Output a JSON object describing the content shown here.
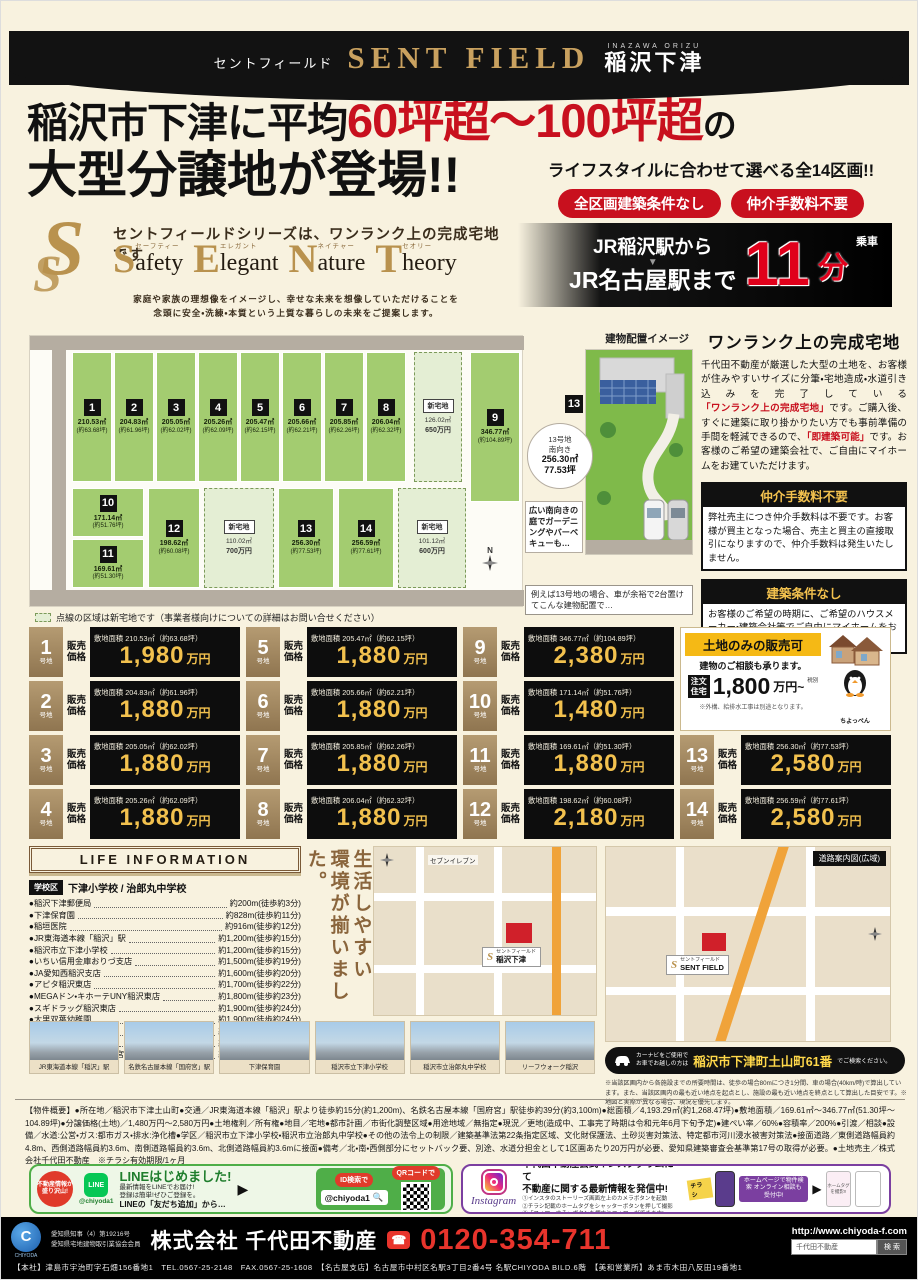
{
  "header": {
    "kana": "セントフィールド",
    "logo": "SENT FIELD",
    "romaji": "INAZAWA ORIZU",
    "area": "稲沢下津"
  },
  "headline": {
    "line1_pre": "稲沢市下津に平均",
    "line1_red": "60坪超～100坪超",
    "line1_post": "の",
    "line2": "大型分譲地が登場!!",
    "sub": "ライフスタイルに合わせて選べる全14区画!!",
    "badges": [
      "全区画建築条件なし",
      "仲介手数料不要"
    ]
  },
  "brand": {
    "tagline": "セントフィールドシリーズは、ワンランク上の完成宅地です",
    "logo_letter": "S",
    "words": [
      {
        "initial": "S",
        "rest": "afety",
        "kana": "セーフティー"
      },
      {
        "initial": "E",
        "rest": "legant",
        "kana": "エレガント"
      },
      {
        "initial": "N",
        "rest": "ature",
        "kana": "ネイチャー"
      },
      {
        "initial": "T",
        "rest": "heory",
        "kana": "セオリー"
      }
    ],
    "desc1": "家庭や家族の理想像をイメージし、幸せな未来を想像していただけることを",
    "desc2": "念頭に安全・洗練・本質という上質な暮らしの未来をご提案します。"
  },
  "access": {
    "from": "JR稲沢駅から",
    "arrow": "▼",
    "to": "JR名古屋駅まで",
    "minutes": "11",
    "unit": "分",
    "ride": "乗車"
  },
  "plan": {
    "caption": "建物配置イメージ",
    "legend": "点線の区域は新宅地です（事業者様向けについての詳細はお問い合せください）",
    "compass": "N",
    "lots": [
      {
        "no": "1",
        "area": "210.53㎡",
        "tsubo": "(約63.68坪)",
        "x": 42,
        "y": 16,
        "w": 40,
        "h": 130
      },
      {
        "no": "2",
        "area": "204.83㎡",
        "tsubo": "(約61.96坪)",
        "x": 84,
        "y": 16,
        "w": 40,
        "h": 130
      },
      {
        "no": "3",
        "area": "205.05㎡",
        "tsubo": "(約62.02坪)",
        "x": 126,
        "y": 16,
        "w": 40,
        "h": 130
      },
      {
        "no": "4",
        "area": "205.26㎡",
        "tsubo": "(約62.09坪)",
        "x": 168,
        "y": 16,
        "w": 40,
        "h": 130
      },
      {
        "no": "5",
        "area": "205.47㎡",
        "tsubo": "(約62.15坪)",
        "x": 210,
        "y": 16,
        "w": 40,
        "h": 130
      },
      {
        "no": "6",
        "area": "205.66㎡",
        "tsubo": "(約62.21坪)",
        "x": 252,
        "y": 16,
        "w": 40,
        "h": 130
      },
      {
        "no": "7",
        "area": "205.85㎡",
        "tsubo": "(約62.26坪)",
        "x": 294,
        "y": 16,
        "w": 40,
        "h": 130
      },
      {
        "no": "8",
        "area": "206.04㎡",
        "tsubo": "(約62.32坪)",
        "x": 336,
        "y": 16,
        "w": 40,
        "h": 130
      },
      {
        "no": "9",
        "area": "346.77㎡",
        "tsubo": "(約104.89坪)",
        "x": 440,
        "y": 16,
        "w": 50,
        "h": 150
      },
      {
        "no": "10",
        "area": "171.14㎡",
        "tsubo": "(約51.76坪)",
        "x": 42,
        "y": 152,
        "w": 72,
        "h": 49
      },
      {
        "no": "11",
        "area": "169.61㎡",
        "tsubo": "(約51.30坪)",
        "x": 42,
        "y": 203,
        "w": 72,
        "h": 49
      },
      {
        "no": "12",
        "area": "198.62㎡",
        "tsubo": "(約60.08坪)",
        "x": 118,
        "y": 152,
        "w": 52,
        "h": 100
      },
      {
        "no": "13",
        "area": "256.30㎡",
        "tsubo": "(約77.53坪)",
        "x": 248,
        "y": 152,
        "w": 56,
        "h": 100
      },
      {
        "no": "14",
        "area": "256.59㎡",
        "tsubo": "(約77.61坪)",
        "x": 308,
        "y": 152,
        "w": 56,
        "h": 100
      }
    ],
    "new_lots": [
      {
        "label": "新宅地",
        "area": "126.02㎡",
        "price": "650万円",
        "x": 384,
        "y": 16,
        "w": 48,
        "h": 130
      },
      {
        "label": "新宅地",
        "area": "110.02㎡",
        "price": "700万円",
        "x": 174,
        "y": 152,
        "w": 70,
        "h": 100
      },
      {
        "label": "新宅地",
        "area": "101.12㎡",
        "price": "600万円",
        "x": 368,
        "y": 152,
        "w": 68,
        "h": 100
      }
    ],
    "callout": {
      "num": "13",
      "l1": "13号地",
      "l2": "南向き",
      "l3": "256.30㎡",
      "l4": "77.53坪"
    },
    "bubble": "広い南向きの庭でガーデニングやバーベキューも…",
    "example": "例えば13号地の場合、車が余裕で2台置けてこんな建物配置で…"
  },
  "feature": {
    "title": "ワンランク上の完成宅地",
    "p1": "千代田不動産が厳選した大型の土地を、お客様が住みやすいサイズに分筆・宅地造成・水道引き込みを完了している",
    "red1": "「ワンランク上の完成宅地」",
    "p2": "です。ご購入後、すぐに建築に取り掛かりたい方でも事前準備の手間を軽減できるので、",
    "red2": "「即建築可能」",
    "p3": "です。お客様のご希望の建築会社で、ご自由にマイホームをお建ていただけます。",
    "box1": {
      "title": "仲介手数料不要",
      "body": "弊社売主につき仲介手数料は不要です。お客様が買主となった場合、売主と買主の直接取引になりますので、仲介手数料は発生いたしません。"
    },
    "box2": {
      "title": "建築条件なし",
      "body": "お客様のご希望の時期に、ご希望のハウスメーカー・建築会社等でご自由にマイホームをお建ていただけます。"
    }
  },
  "prices": {
    "labels": {
      "suffix": "号地",
      "sale1": "販売",
      "sale2": "価格",
      "area_label": "敷地面積",
      "unit": "万円"
    },
    "columns": [
      [
        0,
        1,
        2,
        3
      ],
      [
        4,
        5,
        6,
        7
      ],
      [
        8,
        9,
        10,
        11
      ],
      [
        12,
        13
      ]
    ],
    "lots": [
      {
        "no": "1",
        "area": "敷地面積 210.53㎡（約63.68坪）",
        "price": "1,980"
      },
      {
        "no": "2",
        "area": "敷地面積 204.83㎡（約61.96坪）",
        "price": "1,880"
      },
      {
        "no": "3",
        "area": "敷地面積 205.05㎡（約62.02坪）",
        "price": "1,880"
      },
      {
        "no": "4",
        "area": "敷地面積 205.26㎡（約62.09坪）",
        "price": "1,880"
      },
      {
        "no": "5",
        "area": "敷地面積 205.47㎡（約62.15坪）",
        "price": "1,880"
      },
      {
        "no": "6",
        "area": "敷地面積 205.66㎡（約62.21坪）",
        "price": "1,880"
      },
      {
        "no": "7",
        "area": "敷地面積 205.85㎡（約62.26坪）",
        "price": "1,880"
      },
      {
        "no": "8",
        "area": "敷地面積 206.04㎡（約62.32坪）",
        "price": "1,880"
      },
      {
        "no": "9",
        "area": "敷地面積 346.77㎡（約104.89坪）",
        "price": "2,380"
      },
      {
        "no": "10",
        "area": "敷地面積 171.14㎡（約51.76坪）",
        "price": "1,480"
      },
      {
        "no": "11",
        "area": "敷地面積 169.61㎡（約51.30坪）",
        "price": "1,880"
      },
      {
        "no": "12",
        "area": "敷地面積 198.62㎡（約60.08坪）",
        "price": "2,180"
      },
      {
        "no": "13",
        "area": "敷地面積 256.30㎡（約77.53坪）",
        "price": "2,580"
      },
      {
        "no": "14",
        "area": "敷地面積 256.59㎡（約77.61坪）",
        "price": "2,580"
      }
    ]
  },
  "landonly": {
    "header": "土地のみの販売可",
    "sub": "建物のご相談も承ります。",
    "badge1": "注文",
    "badge2": "住宅",
    "price": "1,800",
    "unit": "万円~",
    "tax": "税別",
    "note": "※外構、給排水工事は別途となります。",
    "mascot": "ちよっぺん"
  },
  "life": {
    "header": "LIFE INFORMATION",
    "school_label": "学校区",
    "school": "下津小学校 / 治郎丸中学校",
    "items": [
      {
        "name": "●稲沢下津郵便局",
        "dist": "約200m(徒歩約3分)"
      },
      {
        "name": "●下津保育園",
        "dist": "約828m(徒歩約11分)"
      },
      {
        "name": "●稲垣医院",
        "dist": "約916m(徒歩約12分)"
      },
      {
        "name": "●JR東海道本線「稲沢」駅",
        "dist": "約1,200m(徒歩約15分)"
      },
      {
        "name": "●稲沢市立下津小学校",
        "dist": "約1,200m(徒歩約15分)"
      },
      {
        "name": "●いちい信用金庫おりづ支店",
        "dist": "約1,500m(徒歩約19分)"
      },
      {
        "name": "●JA愛知西稲沢支店",
        "dist": "約1,600m(徒歩約20分)"
      },
      {
        "name": "●アピタ稲沢東店",
        "dist": "約1,700m(徒歩約22分)"
      },
      {
        "name": "●MEGAドン・キホーテUNY稲沢東店",
        "dist": "約1,800m(徒歩約23分)"
      },
      {
        "name": "●スギドラッグ稲沢東店",
        "dist": "約1,900m(徒歩約24分)"
      },
      {
        "name": "●大里双葉幼稚園",
        "dist": "約1,900m(徒歩約24分)"
      },
      {
        "name": "●リーフウォーク稲沢",
        "dist": "約1,900m(徒歩約24分)"
      },
      {
        "name": "●稲沢市立治郎丸中学校",
        "dist": "約2,800m(徒歩約36分)"
      },
      {
        "name": "●名鉄名古屋本線「国府宮」駅",
        "dist": "約3,100m(徒歩約39分)"
      }
    ],
    "vertical": [
      "周辺施設が充実。",
      "生活しやすい",
      "環境が揃いました。"
    ]
  },
  "maps": {
    "local": {
      "poi": "セブンイレブン",
      "site1": "セントフィールド",
      "site2": "稲沢下津"
    },
    "wide": {
      "badge": "道路案内図(広域)",
      "site1": "セントフィールド",
      "site2": "SENT FIELD"
    },
    "note": "※当該区画内から各施設までの所要時間は、徒歩の場合80mにつき1分間、車の場合(40km/時)で算出しています。また、当該区画内の最も近い地点を起点とし、施設の最も近い地点を終点として算出した目安です。※地図と実際が異なる場合、現況を優先します。"
  },
  "navi": {
    "pre1": "カーナビをご使用で",
    "pre2": "お車でお越しの方は",
    "address": "稲沢市下津町土山町61番",
    "post": "でご検索ください。"
  },
  "photos": [
    "JR東海道本線「稲沢」駅",
    "名鉄名古屋本線「国府宮」駅",
    "下津保育園",
    "稲沢市立下津小学校",
    "稲沢市立治郎丸中学校",
    "リーフウォーク稲沢"
  ],
  "outline": {
    "text": "【物件概要】●所在地／稲沢市下津土山町●交通／JR東海道本線「稲沢」駅より徒歩約15分(約1,200m)、名鉄名古屋本線「国府宮」駅徒歩約39分(約3,100m)●総面積／4,193.29㎡(約1,268.47坪)●敷地面積／169.61㎡～346.77㎡(51.30坪～104.89坪)●分譲価格(土地)／1,480万円～2,580万円●土地権利／所有権●地目／宅地●都市計画／市街化調整区域●用途地域／無指定●現況／更地(造成中、工事完了時期は令和元年6月下旬予定)●建ぺい率／60%●容積率／200%●引渡／相談●設備／水道:公営・ガス:都市ガス・排水:浄化槽●学区／稲沢市立下津小学校・稲沢市立治郎丸中学校●その他の法令上の制限／建築基準法第22条指定区域、文化財保護法、土砂災害対策法、特定都市河川浸水被害対策法●接面道路／東側道路幅員約4.8m、西側道路幅員約3.6m、南側道路幅員約3.6m、北側道路幅員約3.6mに接面●備考／北・南・西側部分にセットバック要、別途、水道分担金として1区画あたり20万円が必要、愛知県建築審査会基準第17号の取得が必要。●土地売主／株式会社千代田不動産　※チラシ有効期限/1ヶ月"
  },
  "line_promo": {
    "burst": "不動産情報が盛り沢山!",
    "brand": "LINE",
    "handle": "@chiyoda1",
    "title": "LINEはじめました!",
    "s1": "最新情報をLINEでお届け!",
    "s2": "登録は簡単!ぜひご登録を。",
    "s3": "LINEの「友だち追加」から…",
    "id_badge": "ID検索で",
    "id_value": "@chiyoda1",
    "qr_badge": "QRコードで"
  },
  "insta_promo": {
    "logo": "Instagram",
    "t1": "千代田不動産公式インスタグラムにて",
    "t2": "不動産に関する最新情報を発信中!",
    "b1": "①インスタのストーリーズ画面左上のカメラボタンを起動",
    "b2": "②チラシ記載のホームタグをシャッターボタンを押して撮影",
    "b3": "③「フォローする」ボタンを押すとフォローができます!",
    "tag": "チラシ",
    "badge": "ホームページで物件検索 オンライン相談も受付中!",
    "card": "ホームタグを撮影!!"
  },
  "footer": {
    "logo": "C",
    "logo_caption": "CHIYODA",
    "license1": "愛知県知事（4）第19216号",
    "license2": "愛知県宅地建物取引業協会会員",
    "company": "株式会社 千代田不動産",
    "dial": "☎",
    "tel": "0120-354-711",
    "url": "http://www.chiyoda-f.com",
    "search_value": "千代田不動産",
    "search_btn": "検 索",
    "branches": "【本社】津島市宇治町字石畑156番地1　TEL.0567-25-2148　FAX.0567-25-1608　【名古屋支店】名古屋市中村区名駅3丁目2番4号 名駅CHIYODA BILD.6階　【美和営業所】あま市木田八反田19番地1"
  }
}
